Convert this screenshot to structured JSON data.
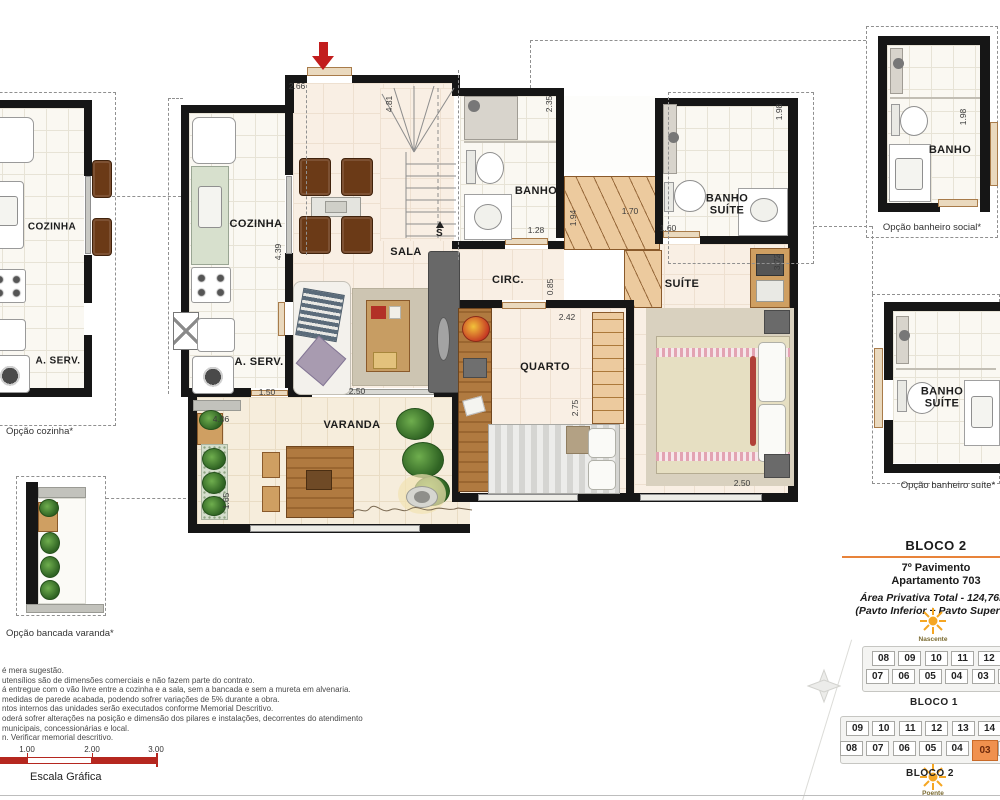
{
  "plan": {
    "rooms": {
      "cozinha": "COZINHA",
      "aserv": "A. SERV.",
      "sala": "SALA",
      "banho": "BANHO",
      "circ": "CIRC.",
      "suite": "SUÍTE",
      "banho_suite": "BANHO SUÍTE",
      "quarto": "QUARTO",
      "varanda": "VARANDA"
    },
    "stair_marker": "S",
    "dims": {
      "entry": "2.66",
      "stair": "4.81",
      "banho_h": "2.35",
      "banho_w": "1.28",
      "closet_v": "1.94",
      "closet_w": "1.70",
      "bsuite_w": "1.60",
      "bsuite_v": "1.98",
      "suite_v": "3.72",
      "circ_v": "0.85",
      "quarto_w": "2.42",
      "quarto_v": "2.75",
      "suite_w": "2.50",
      "sala_w": "2.50",
      "aserv_w": "1.50",
      "cozinha_v": "4.39",
      "varanda_w": "4.06",
      "varanda_v": "1.65",
      "opt_social_v": "1.98"
    }
  },
  "options": {
    "cozinha_caption": "Opção cozinha*",
    "bancada_caption": "Opção bancada varanda*",
    "social_caption": "Opção banheiro social*",
    "suite_caption": "Opção banheiro suíte*",
    "cozinha_label": "COZINHA",
    "aserv_label": "A. SERV.",
    "banho_label": "BANHO",
    "banho_suite_label": "BANHO SUÍTE"
  },
  "info": {
    "bloco": "BLOCO 2",
    "pavimento": "7º Pavimento",
    "apartamento": "Apartamento 703",
    "area": "Área Privativa Total - 124,76m²",
    "pavtos": "(Pavto Inferior + Pavto Superior)"
  },
  "orientation": {
    "nascente": "Nascente",
    "poente": "Poente"
  },
  "keyplan": {
    "bloco1": {
      "label": "BLOCO 1",
      "row_top": [
        "08",
        "09",
        "10",
        "11",
        "12",
        "01"
      ],
      "row_bottom": [
        "07",
        "06",
        "05",
        "04",
        "03",
        "02"
      ]
    },
    "bloco2": {
      "label": "BLOCO 2",
      "row_top": [
        "09",
        "10",
        "11",
        "12",
        "13",
        "14",
        "01"
      ],
      "row_bottom": [
        "08",
        "07",
        "06",
        "05",
        "04",
        "03",
        "02"
      ],
      "highlight": "03"
    }
  },
  "notes": [
    "é mera sugestão.",
    "utensílios são de dimensões comerciais e não fazem parte do contrato.",
    "á entregue com o vão livre entre a cozinha e a sala, sem a bancada e sem a mureta em alvenaria.",
    "medidas de parede acabada, podendo sofrer variações de 5% durante a obra.",
    "ntos internos das unidades serão executados conforme Memorial Descritivo.",
    "oderá sofrer alterações na posição e dimensão dos pilares e instalações, decorrentes do atendimento",
    "municipais, concessionárias e local.",
    "n. Verificar memorial descritivo."
  ],
  "scale": {
    "ticks": [
      "0",
      "1.00",
      "2.00",
      "3.00"
    ],
    "label": "Escala Gráfica"
  },
  "colors": {
    "accent_orange": "#ef8f4e",
    "line_orange": "#e8833a",
    "wall": "#161616",
    "scale_red": "#b5271f"
  }
}
